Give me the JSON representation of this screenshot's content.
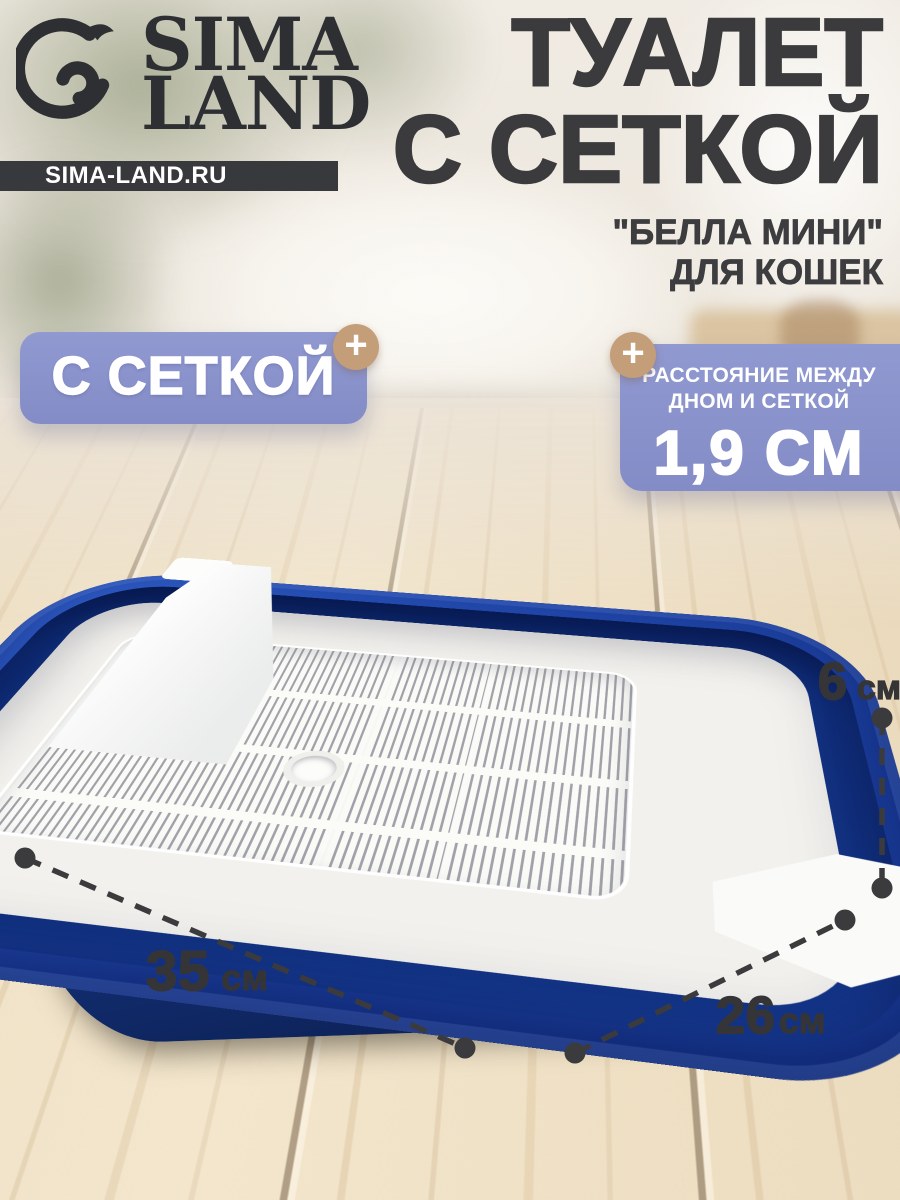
{
  "brand": {
    "logo_top": "SIMA",
    "logo_bottom": "LAND",
    "site": "SIMA-LAND.RU"
  },
  "title": {
    "line1": "ТУАЛЕТ",
    "line2": "С СЕТКОЙ"
  },
  "subtitle": {
    "line1": "\"БЕЛЛА МИНИ\"",
    "line2": "ДЛЯ КОШЕК"
  },
  "badge_left": {
    "label": "С СЕТКОЙ",
    "plus": "+"
  },
  "badge_right": {
    "line1": "РАССТОЯНИЕ МЕЖДУ",
    "line2": "ДНОМ И СЕТКОЙ",
    "value": "1,9 СМ",
    "plus": "+"
  },
  "dimensions": {
    "height": {
      "value": "6",
      "unit": "см"
    },
    "length": {
      "value": "35",
      "unit": "см"
    },
    "width": {
      "value": "26",
      "unit": "см"
    }
  },
  "colors": {
    "badge_lavender": "#8a92cb",
    "plus_tan": "#c49d79",
    "tray_navy": "#143589",
    "text_dark": "#3a3a3c",
    "wood": "#ecdcc1"
  }
}
